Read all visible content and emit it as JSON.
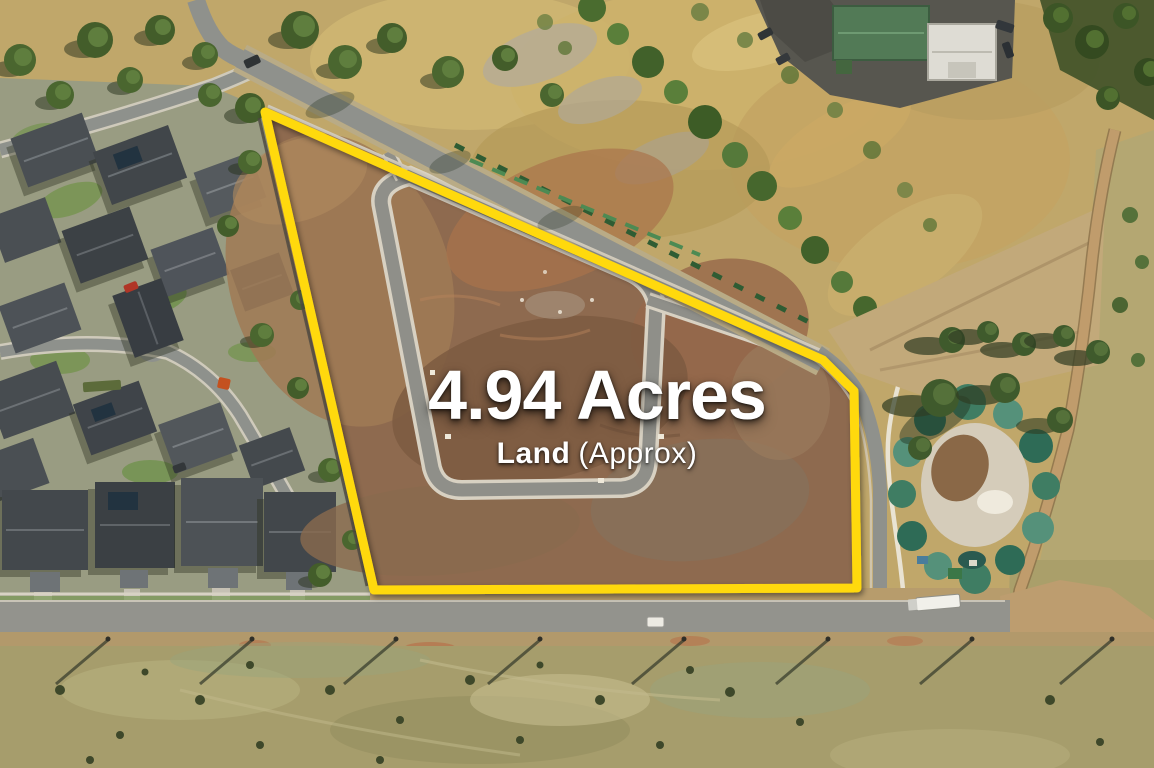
{
  "photo": {
    "type": "aerial-drone-photo",
    "subject": "Vacant subdivision land parcel outlined in yellow, bordered by a suburban estate on the left, a road along the top and bottom, dry paddocks and a vegetated dam mound on the right"
  },
  "overlay": {
    "headline": "4.94 Acres",
    "subheadline_bold": "Land",
    "subheadline_regular": "(Approx)"
  },
  "boundary": {
    "color": "#FFD911",
    "points": "265,112 823,360 854,391 857,588 374,590"
  }
}
